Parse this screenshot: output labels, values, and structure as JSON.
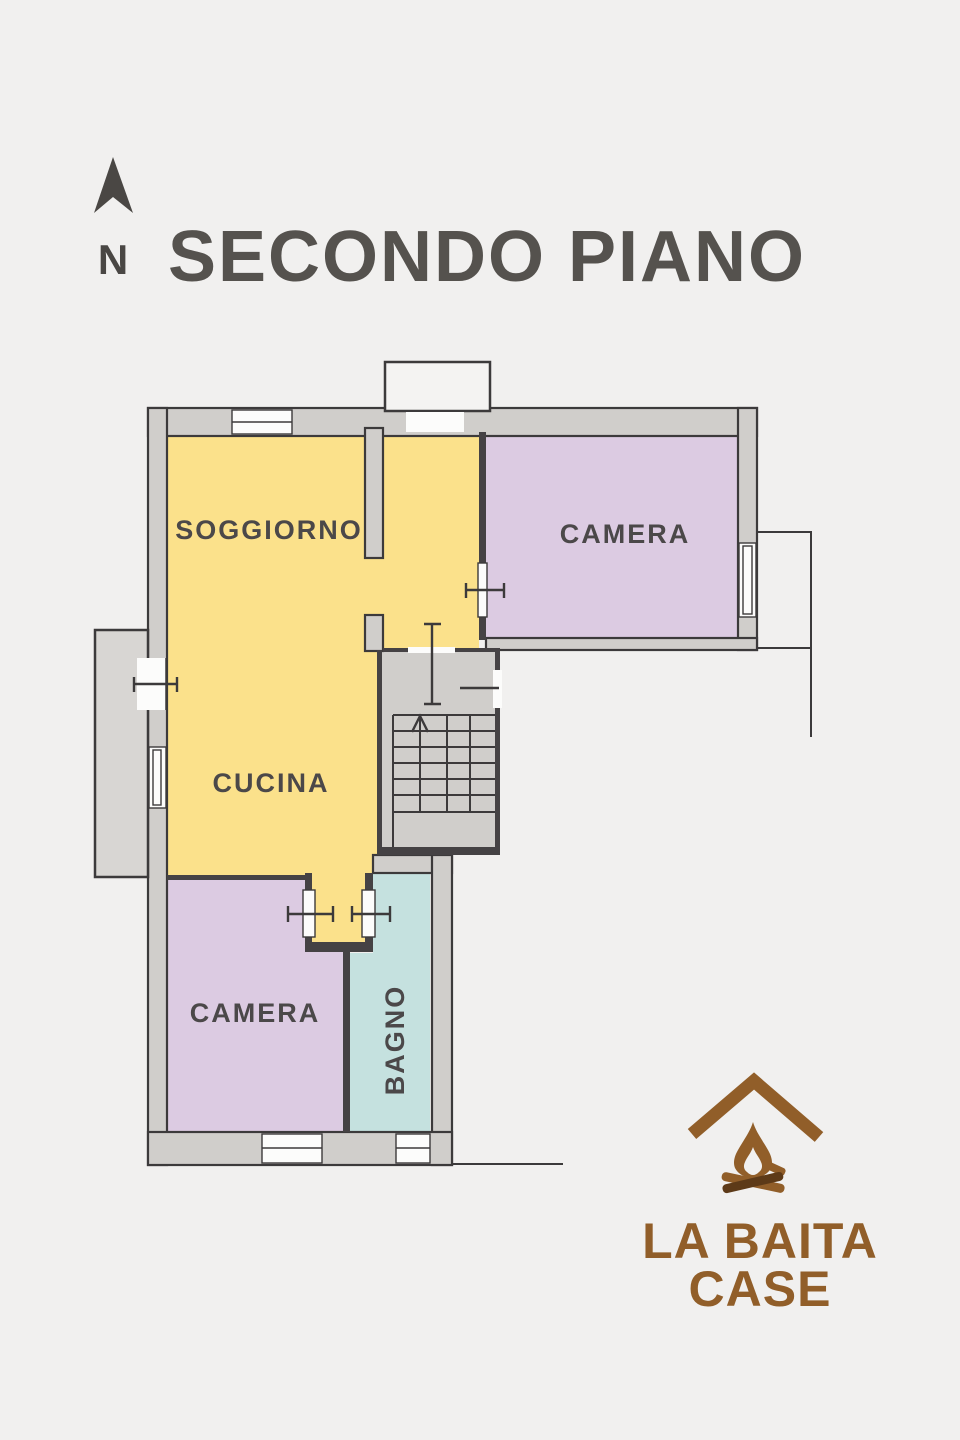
{
  "title": "SECONDO PIANO",
  "north": {
    "label": "N"
  },
  "colors": {
    "background": "#f1f0ef",
    "wall_fill": "#d0cecb",
    "wall_outline": "#3c3a3b",
    "room_yellow": "#fbe18b",
    "room_purple": "#dccbe2",
    "room_teal": "#c5e1df",
    "label_text": "#4b4849",
    "title_text": "#55524e",
    "logo_brown": "#915e29",
    "logo_dark_brown": "#5d3a18"
  },
  "rooms": [
    {
      "id": "soggiorno",
      "label": "SOGGIORNO",
      "color": "#fbe18b"
    },
    {
      "id": "camera-nord",
      "label": "CAMERA",
      "color": "#dccbe2"
    },
    {
      "id": "cucina",
      "label": "CUCINA",
      "color": "#fbe18b"
    },
    {
      "id": "camera-sud",
      "label": "CAMERA",
      "color": "#dccbe2"
    },
    {
      "id": "bagno",
      "label": "BAGNO",
      "color": "#c5e1df"
    }
  ],
  "logo": {
    "line1": "LA BAITA",
    "line2": "CASE"
  }
}
